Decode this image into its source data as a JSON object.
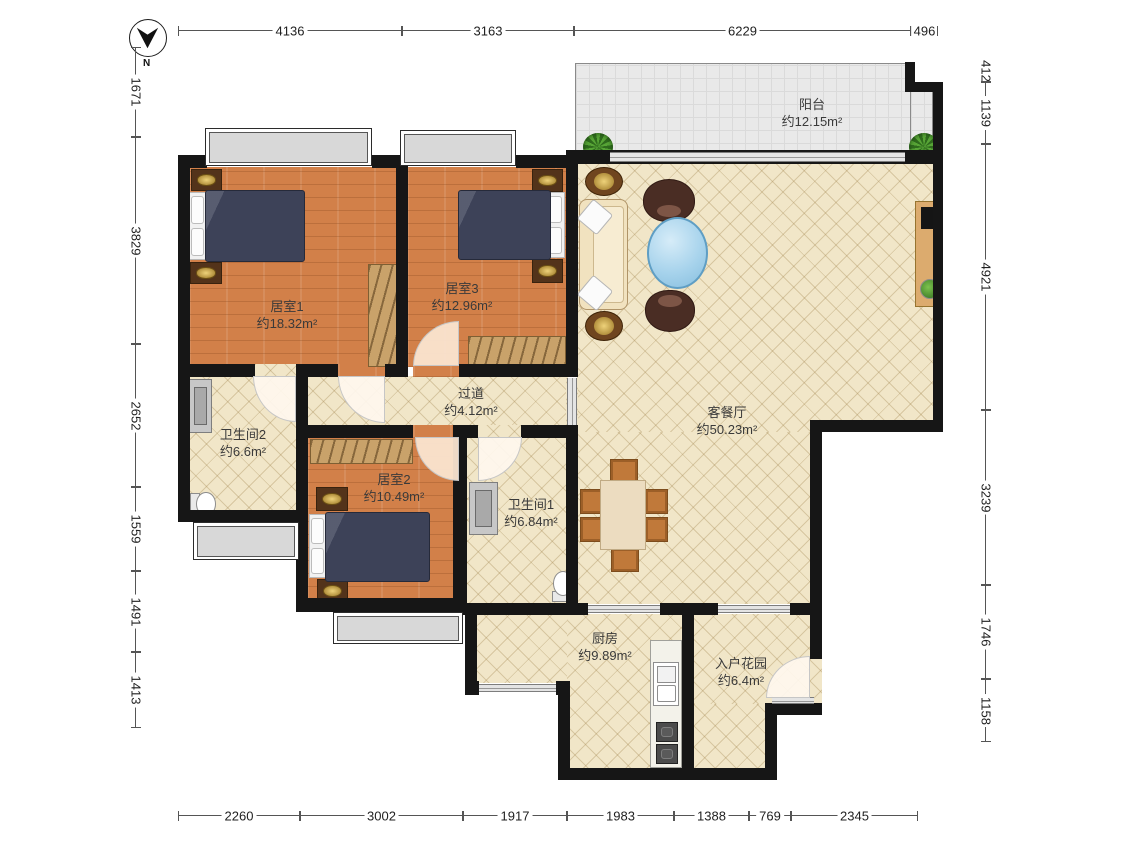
{
  "compass": {
    "label": "N"
  },
  "rooms": {
    "balcony": {
      "name": "阳台",
      "area": "约12.15m²"
    },
    "bedroom1": {
      "name": "居室1",
      "area": "约18.32m²"
    },
    "bedroom3": {
      "name": "居室3",
      "area": "约12.96m²"
    },
    "hallway": {
      "name": "过道",
      "area": "约4.12m²"
    },
    "living": {
      "name": "客餐厅",
      "area": "约50.23m²"
    },
    "bathroom2": {
      "name": "卫生间2",
      "area": "约6.6m²"
    },
    "bedroom2": {
      "name": "居室2",
      "area": "约10.49m²"
    },
    "bathroom1": {
      "name": "卫生间1",
      "area": "约6.84m²"
    },
    "kitchen": {
      "name": "厨房",
      "area": "约9.89m²"
    },
    "garden": {
      "name": "入户花园",
      "area": "约6.4m²"
    }
  },
  "dimensions": {
    "top": [
      "4136",
      "3163",
      "6229",
      "496"
    ],
    "bottom": [
      "2260",
      "3002",
      "1917",
      "1983",
      "1388",
      "769",
      "2345"
    ],
    "left": [
      "1671",
      "3829",
      "2652",
      "1559",
      "1491",
      "1413"
    ],
    "right": [
      "412",
      "1139",
      "4921",
      "3239",
      "1746",
      "1158"
    ]
  },
  "colors": {
    "wall": "#161616",
    "wood_floor": "#d28049",
    "tile_floor": "#f1e6c8",
    "balcony_floor": "#e9e9e9",
    "bed": "#3d4258",
    "wardrobe": "#c9a26a",
    "coffee_table": "#a7d3ec"
  }
}
